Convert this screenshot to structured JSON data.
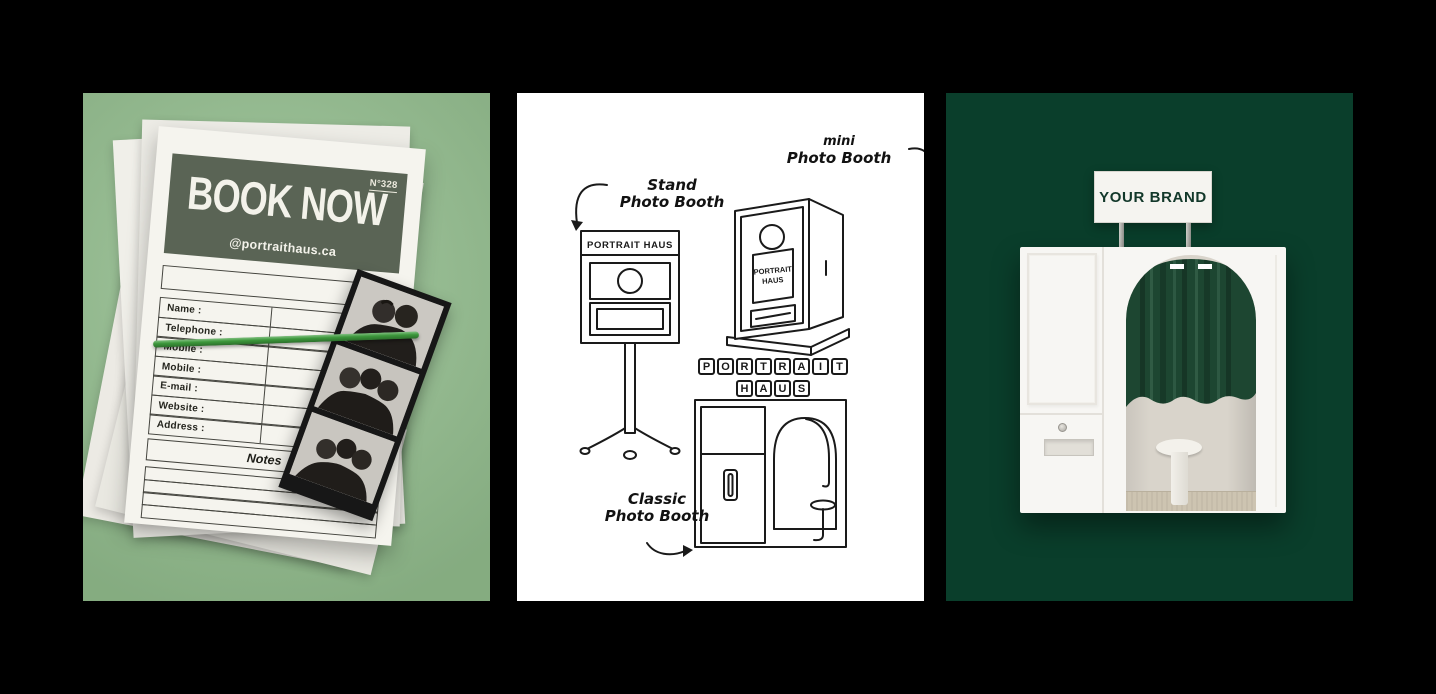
{
  "colors": {
    "page_bg": "#000000",
    "left_bg": "#94bf8f",
    "form_header_bg": "#5a6455",
    "band_green": "#3f9f3e",
    "middle_bg": "#ffffff",
    "right_bg": "#0a3e2b",
    "curtain_green": "#1d4631",
    "sign_text_color": "#12382a"
  },
  "left_panel": {
    "form_number": "N°328",
    "title": "BOOK NOW",
    "website_handle": "@portraithaus.ca",
    "fields": [
      "Name :",
      "Telephone :",
      "Mobile :",
      "Mobile :",
      "E-mail :",
      "Website :",
      "Address :"
    ],
    "notes_label": "Notes"
  },
  "middle_panel": {
    "stand_label_line1": "Stand",
    "stand_label_line2": "Photo Booth",
    "mini_label_line1": "mini",
    "mini_label_line2": "Photo Booth",
    "classic_label_line1": "Classic",
    "classic_label_line2": "Photo Booth",
    "stand_booth_title": "PORTRAIT HAUS",
    "mini_screen_line1": "PORTRAIT",
    "mini_screen_line2": "HAUS",
    "tiles_row1": [
      "P",
      "O",
      "R",
      "T",
      "R",
      "A",
      "I",
      "T"
    ],
    "tiles_row2": [
      "H",
      "A",
      "U",
      "S"
    ]
  },
  "right_panel": {
    "sign_text": "YOUR BRAND"
  }
}
